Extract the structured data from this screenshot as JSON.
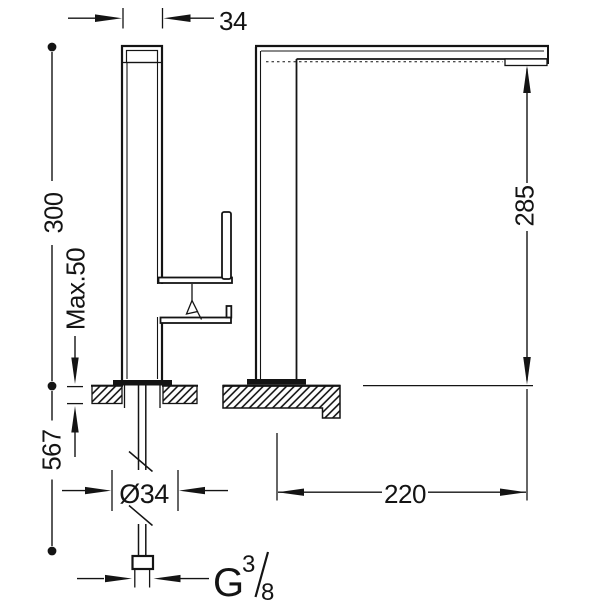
{
  "labels": {
    "top_width": "34",
    "height_above_counter": "300",
    "max_counter_thickness": "Max.50",
    "hose_length": "567",
    "base_diameter": "Ø34",
    "spout_height": "285",
    "spout_reach": "220",
    "thread_letter": "G",
    "thread_numerator": "3",
    "thread_denominator": "8"
  },
  "colors": {
    "line": "#141414",
    "background": "#ffffff"
  }
}
